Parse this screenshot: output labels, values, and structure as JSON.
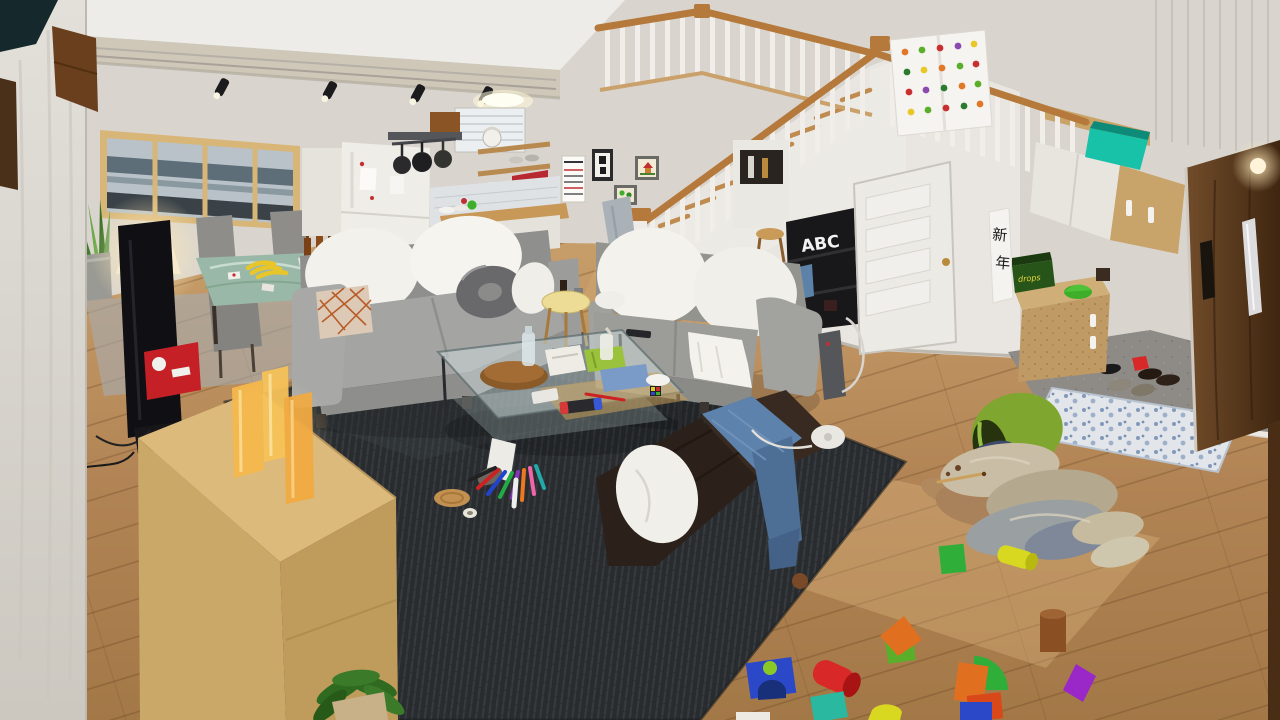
{
  "scene": {
    "type": "3D rendered interior",
    "description": "Open-plan living room with loft staircase, kitchen, dining nook and genkan entryway; toy blocks and spilled laundry scattered on the wood floor and dark rug",
    "text": {
      "bookshelf_label": "ABC",
      "scroll_char_top": "新",
      "scroll_char_bottom": "年",
      "candy_box_label": "drops"
    },
    "palette": {
      "wall": "#d9d5ce",
      "ceiling": "#edece8",
      "floor_wood": "#b98d5c",
      "rug": "#2a2d30",
      "sofa_gray": "#9c9c98",
      "chaise_brown": "#2e231b",
      "door_brown": "#5a3a1e",
      "handrail_oak": "#b5793b",
      "genkan_tile": "#8e8b87",
      "candle_amber": "#f4b84c",
      "bucket_green": "#7fa62e",
      "towel_blue": "#5d82ab"
    },
    "objects": [
      "track lights",
      "loft railing",
      "staircase",
      "vegetable-print tapestry",
      "wall calendar",
      "framed calligraphy",
      "kids drawings",
      "refrigerator",
      "hanging pans",
      "kettle shelf",
      "red toaster oven",
      "rice cooker",
      "dining table with bananas",
      "dining chairs",
      "floor lamp",
      "window with city view",
      "snake plant",
      "television",
      "red game-console box",
      "wood sideboard",
      "amber candles",
      "gray sofa",
      "white cushions",
      "donut pillow",
      "patterned pillow",
      "glass coffee table",
      "tissue box",
      "snack bag",
      "game controller",
      "round side table",
      "dark floor chaise",
      "blue towel",
      "electric fan",
      "marker spill",
      "cork coaster",
      "tipped laundry bucket",
      "clothes pile",
      "wooden toy blocks",
      "ABC bookshelf",
      "under-stair door",
      "new year scroll",
      "drops candy box",
      "entry wall cabinets",
      "teal box",
      "front door with bar handle",
      "genkan tile step",
      "blue floral mat",
      "slippers",
      "black shoes",
      "potted plant"
    ]
  }
}
